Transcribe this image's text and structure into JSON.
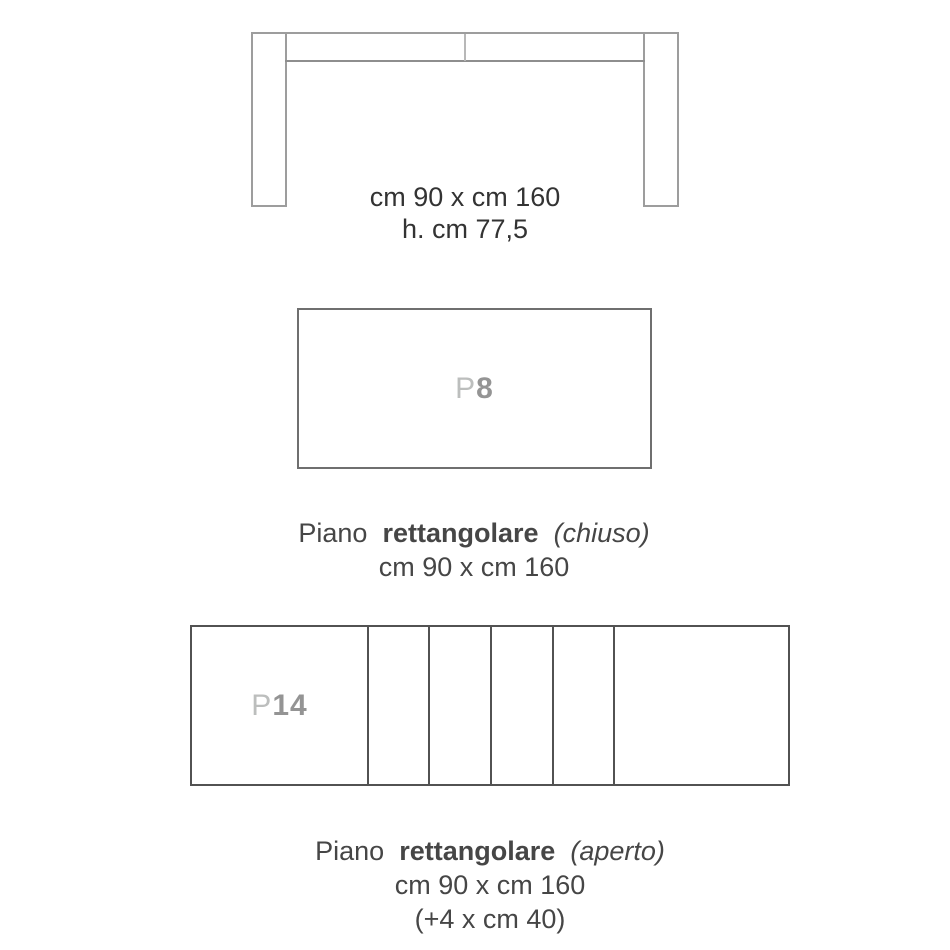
{
  "front_view": {
    "dimensions_line1": "cm 90 x cm 160",
    "dimensions_line2": "h. cm 77,5"
  },
  "closed_top": {
    "label_prefix": "P",
    "label_number": "8",
    "caption_word1": "Piano",
    "caption_word2": "rettangolare",
    "caption_word3": "(chiuso)",
    "caption_line2": "cm 90 x cm 160"
  },
  "open_top": {
    "label_prefix": "P",
    "label_number": "14",
    "leaf_count": 4,
    "caption_word1": "Piano",
    "caption_word2": "rettangolare",
    "caption_word3": "(aperto)",
    "caption_line2": "cm 90 x cm 160",
    "caption_line3": "(+4 x cm 40)"
  },
  "colors": {
    "drawing_light": "#9d9d9d",
    "drawing_medium": "#6f6f6f",
    "drawing_dark": "#525252",
    "label_light": "#bcbebd",
    "label_dark": "#949494",
    "text_dark": "#333333",
    "text": "#464646",
    "background": "#ffffff"
  }
}
